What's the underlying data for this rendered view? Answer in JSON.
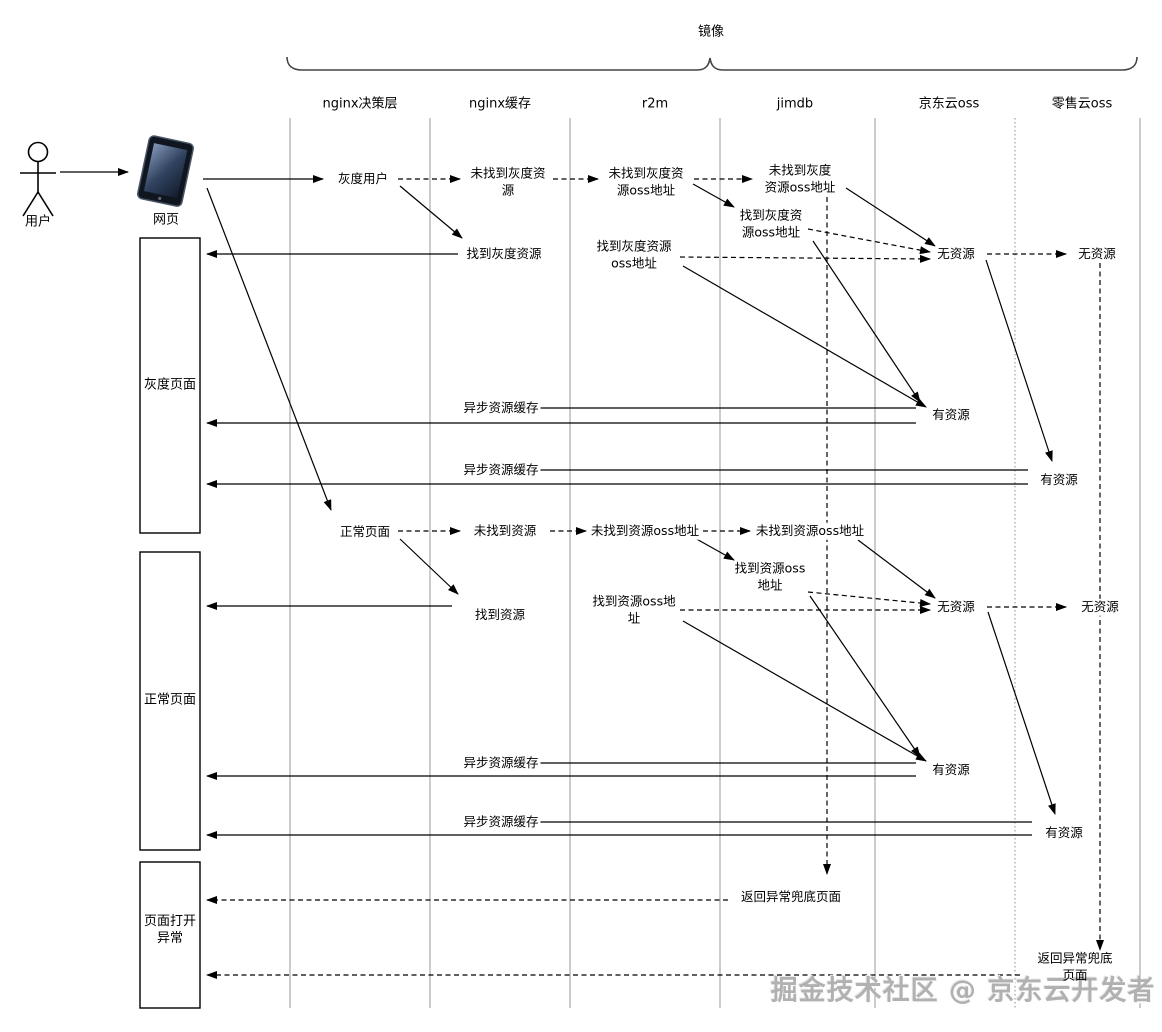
{
  "diagram": {
    "mirror_label": "镜像",
    "watermark": "掘金技术社区 @ 京东云开发者"
  },
  "actors": {
    "user": "用户",
    "web": "网页"
  },
  "columns": [
    {
      "label": "nginx决策层"
    },
    {
      "label": "nginx缓存"
    },
    {
      "label": "r2m"
    },
    {
      "label": "jimdb"
    },
    {
      "label": "京东云oss"
    },
    {
      "label": "零售云oss"
    }
  ],
  "sections": [
    {
      "label": "灰度页面"
    },
    {
      "label": "正常页面"
    },
    {
      "label": "页面打开\n异常"
    }
  ],
  "gray": {
    "entry": "灰度用户",
    "cache_miss": "未找到灰度资\n源",
    "r2m_miss": "未找到灰度资\n源oss地址",
    "jimdb_miss": "未找到灰度\n资源oss地址",
    "cache_hit": "找到灰度资源",
    "r2m_hit": "找到灰度资源\noss地址",
    "jimdb_hit": "找到灰度资\n源oss地址",
    "jd_oss_none": "无资源",
    "retail_oss_none": "无资源",
    "async_cache_1": "异步资源缓存",
    "jd_oss_has": "有资源",
    "async_cache_2": "异步资源缓存",
    "retail_oss_has": "有资源"
  },
  "normal": {
    "entry": "正常页面",
    "cache_miss": "未找到资源",
    "r2m_miss": "未找到资源oss地址",
    "jimdb_miss": "未找到资源oss地址",
    "cache_hit": "找到资源",
    "r2m_hit": "找到资源oss地\n址",
    "jimdb_hit": "找到资源oss\n地址",
    "jd_oss_none": "无资源",
    "retail_oss_none": "无资源",
    "async_cache_1": "异步资源缓存",
    "jd_oss_has": "有资源",
    "async_cache_2": "异步资源缓存",
    "retail_oss_has": "有资源"
  },
  "exception": {
    "return_fallback_jimdb": "返回异常兜底页面",
    "return_fallback_retail": "返回异常兜底页面"
  }
}
